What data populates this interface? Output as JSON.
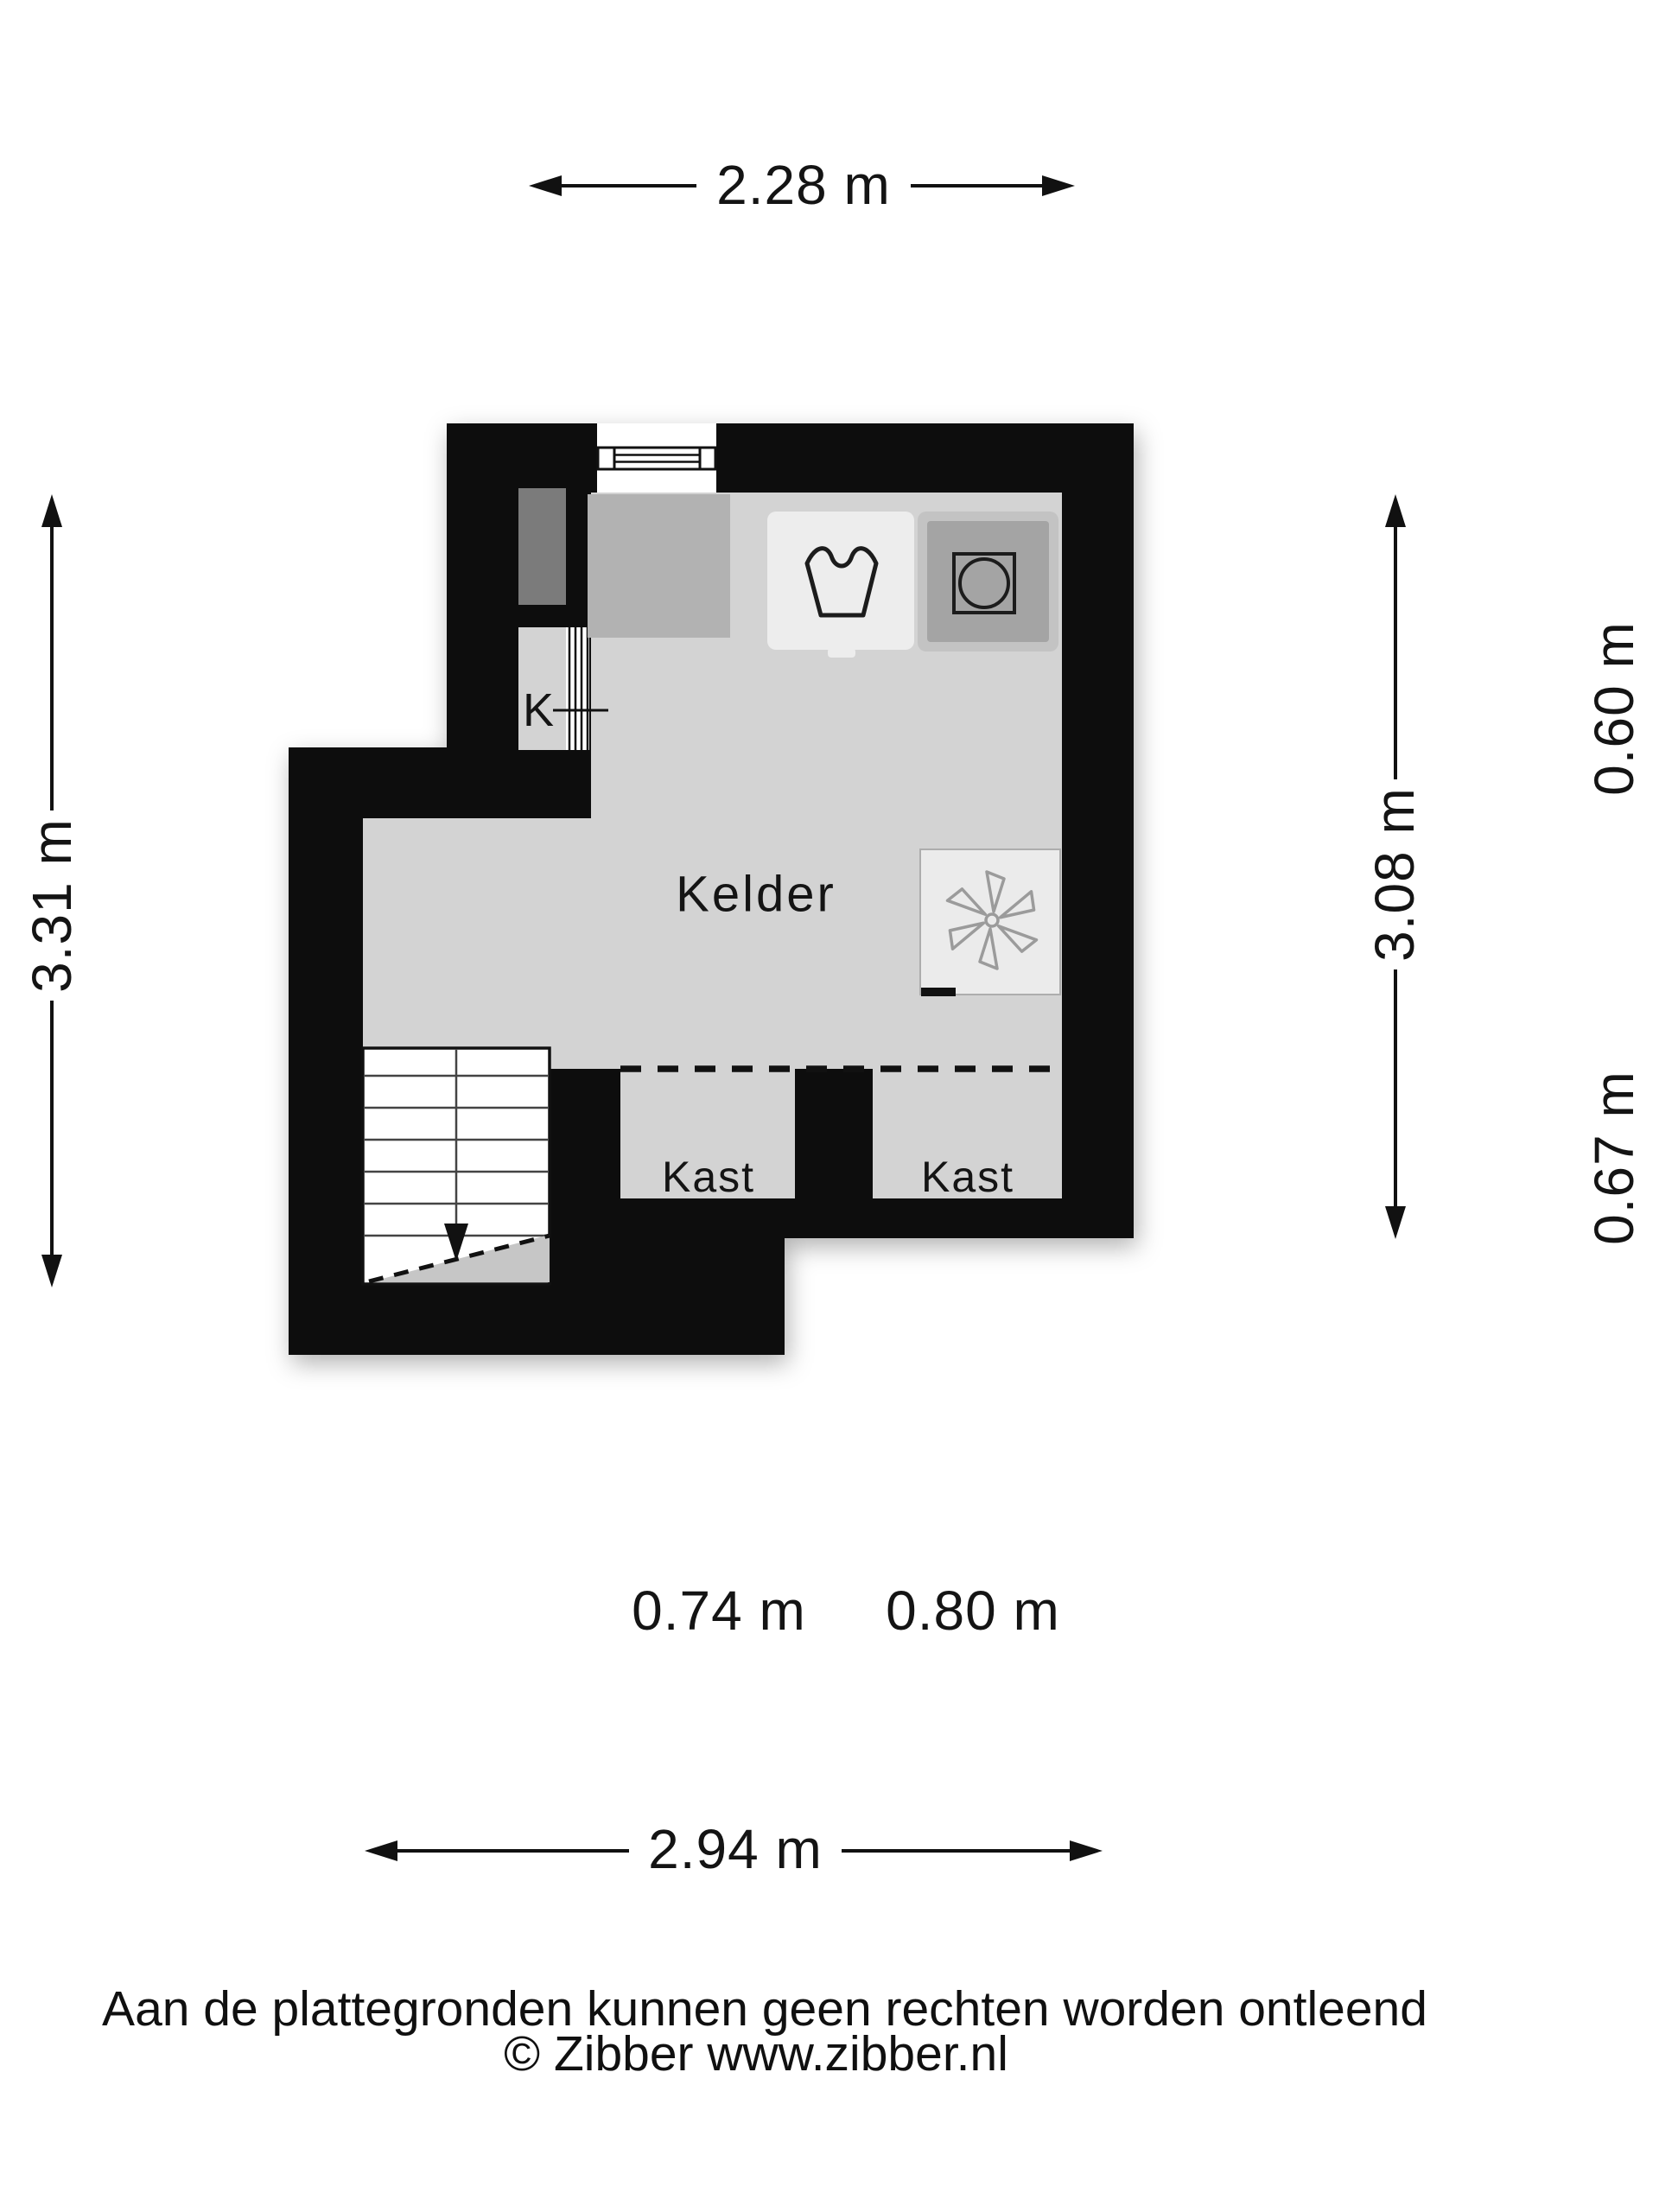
{
  "plan": {
    "room_label": "Kelder",
    "closet_left_label": "Kast",
    "closet_right_label": "Kast",
    "hatch_label": "K"
  },
  "dimensions": {
    "top_width": "2.28 m",
    "left_height": "3.31 m",
    "right_height": "3.08 m",
    "right_segment_upper": "0.60 m",
    "right_segment_lower": "0.67 m",
    "closet_left_width": "0.74 m",
    "closet_right_width": "0.80 m",
    "bottom_width": "2.94 m"
  },
  "footer": {
    "disclaimer": "Aan de plattegronden kunnen geen rechten worden ontleend",
    "copyright": "© Zibber www.zibber.nl"
  },
  "colors": {
    "wall": "#0a0a0a",
    "floor": "#d3d3d3",
    "worktop": "#b2b2b2",
    "niche": "#7b7b7b",
    "appliance_dark": "#a4a4a4",
    "appliance_light": "#ededed",
    "fan_box": "#ebebeb",
    "background": "#ffffff"
  }
}
